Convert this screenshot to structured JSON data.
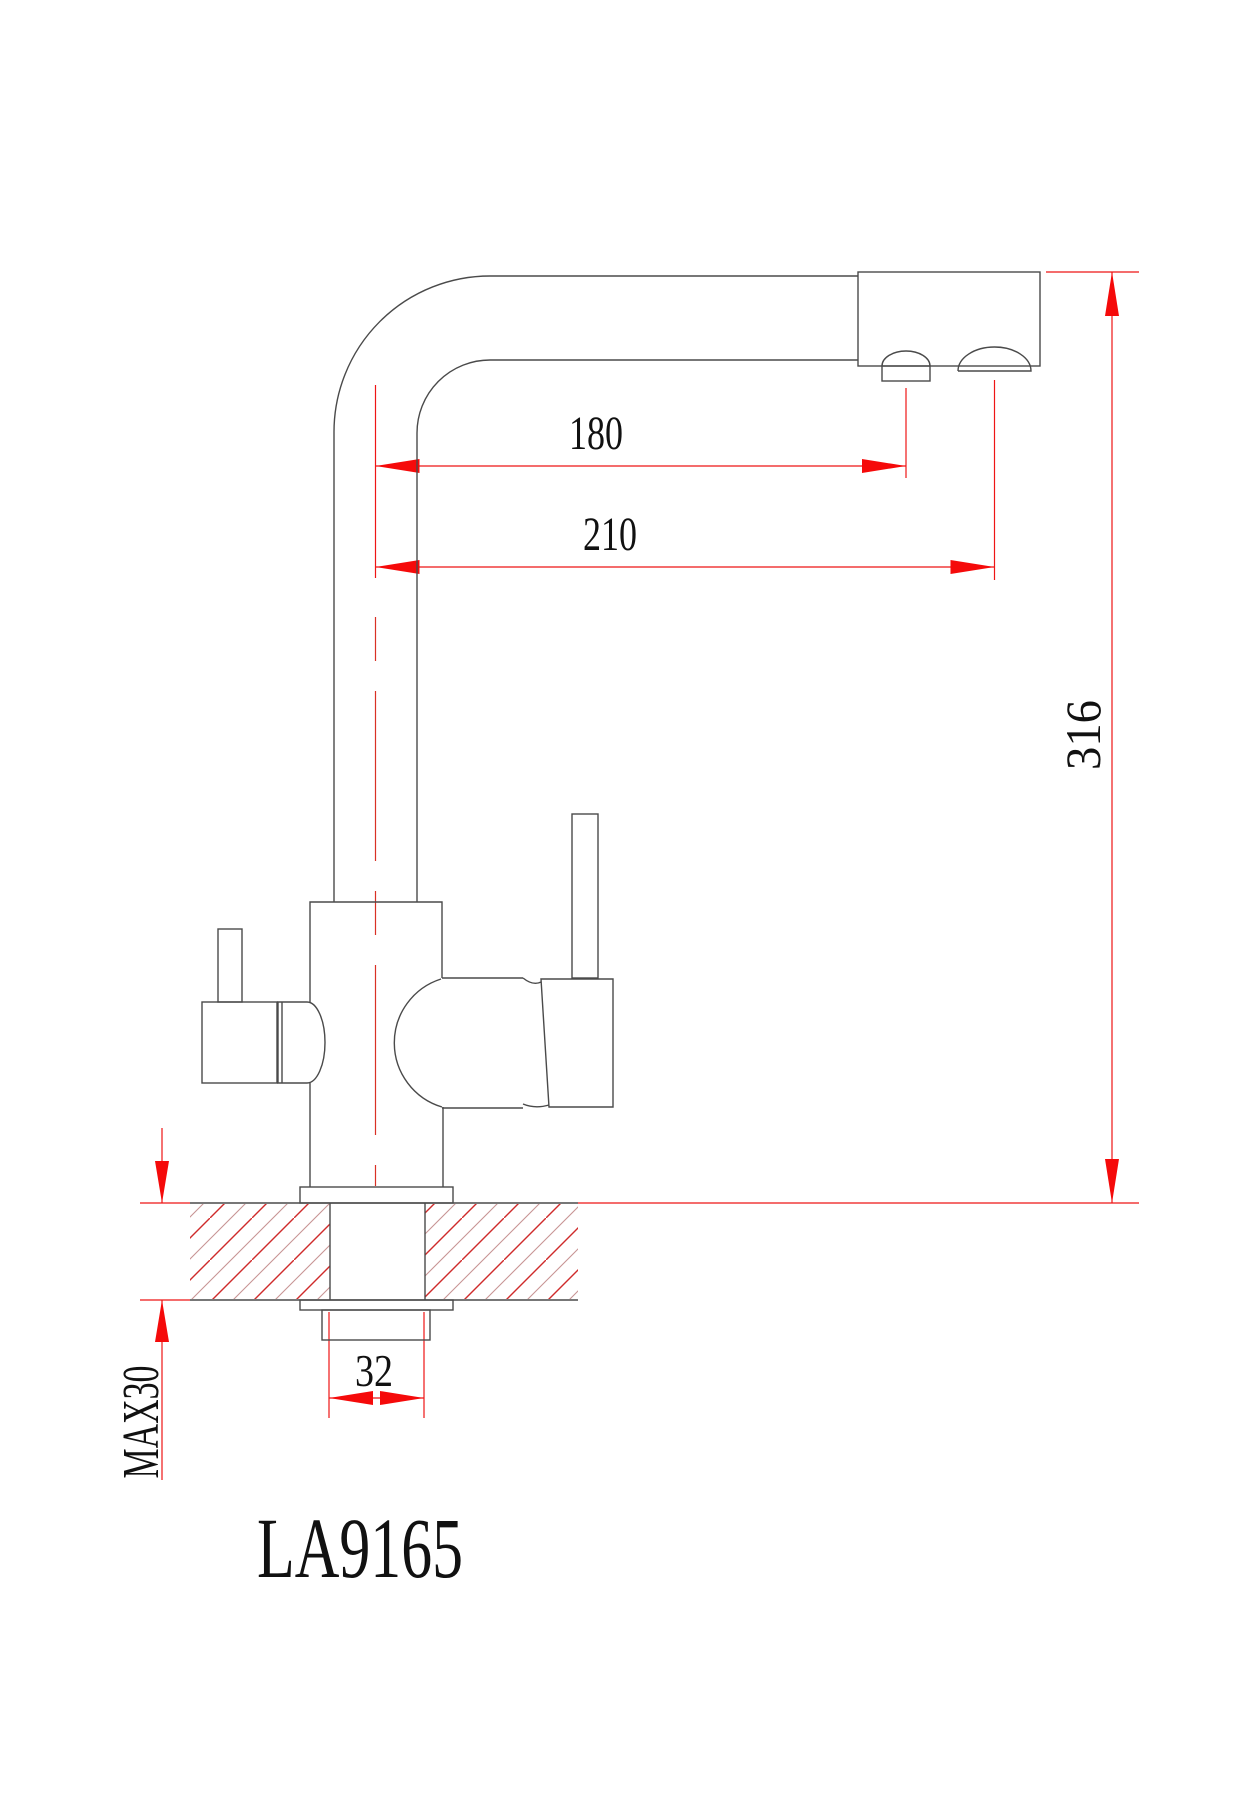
{
  "drawing": {
    "model_label": "LA9165",
    "dimensions": {
      "reach_filtered_outlet": "180",
      "reach_main_outlet": "210",
      "overall_height": "316",
      "shank_diameter": "32",
      "max_countertop_thickness": "MAX30"
    },
    "colors": {
      "outline": "#4a4a4a",
      "dimension_red": "#ee1515",
      "arrow_red": "#f50a0a",
      "hatch_red_strong": "#cf2b2b",
      "hatch_red_light": "#c79494",
      "text": "#111111",
      "background": "#ffffff"
    }
  }
}
